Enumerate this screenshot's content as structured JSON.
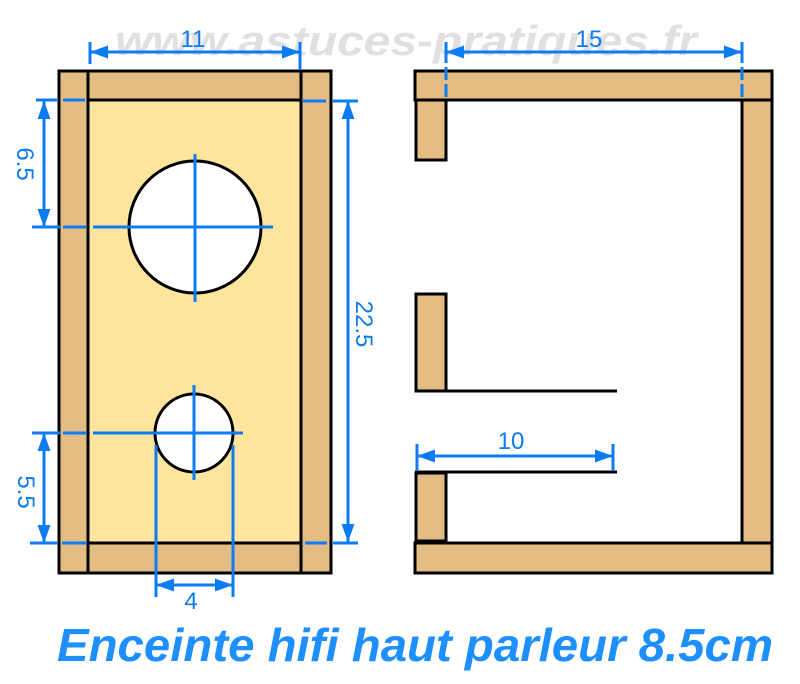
{
  "title": "Enceinte hifi haut parleur 8.5cm",
  "watermark": "www.astuces-pratiques.fr",
  "colors": {
    "wood": "#e2bc82",
    "panel": "#fde59e",
    "hole": "#ffffff",
    "outline": "#000000",
    "dim": "#0d7cf2",
    "titleblue": "#1e8fff",
    "watermark": "#e0e0e0"
  },
  "front_view": {
    "dims": {
      "inner_width": "11",
      "speaker_center_from_top": "6.5",
      "inner_height": "22.5",
      "port_center_from_bottom": "5.5",
      "port_hole_diameter": "4"
    }
  },
  "side_view": {
    "dims": {
      "inner_depth": "15",
      "port_duct_length": "10"
    }
  }
}
